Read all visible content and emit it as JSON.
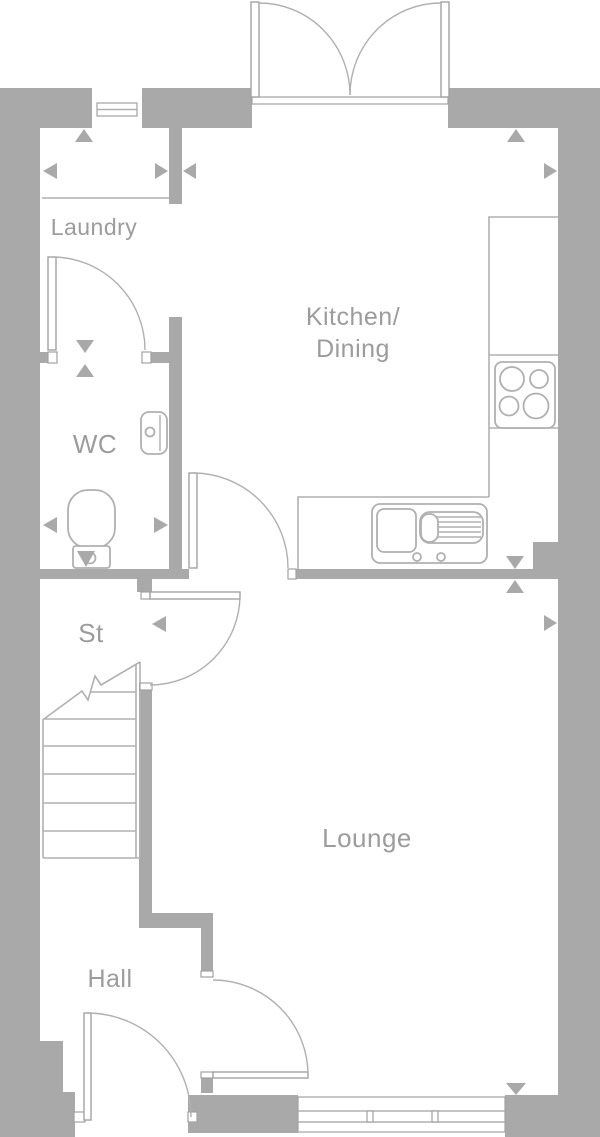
{
  "title": "Ground floor plan",
  "colors": {
    "bg": "#ffffff",
    "wall": "#a9a9a9",
    "line": "#b0b0b0",
    "frame": "#a2a2a2",
    "label": "#9c9c9c"
  },
  "rooms": {
    "laundry": {
      "label": "Laundry"
    },
    "kitchen_dining": {
      "line1": "Kitchen/",
      "line2": "Dining"
    },
    "wc": {
      "label": "WC"
    },
    "storage": {
      "label": "St"
    },
    "lounge": {
      "label": "Lounge"
    },
    "hall": {
      "label": "Hall"
    }
  },
  "fixtures": {
    "hob": "hob-icon",
    "sink": "sink-drainer-icon",
    "toilet": "toilet-icon",
    "basin": "basin-icon",
    "stairs": "staircase",
    "french_doors": "french-doors",
    "windows": [
      "laundry-window",
      "lounge-window"
    ],
    "markers": "dimension-arrow"
  }
}
